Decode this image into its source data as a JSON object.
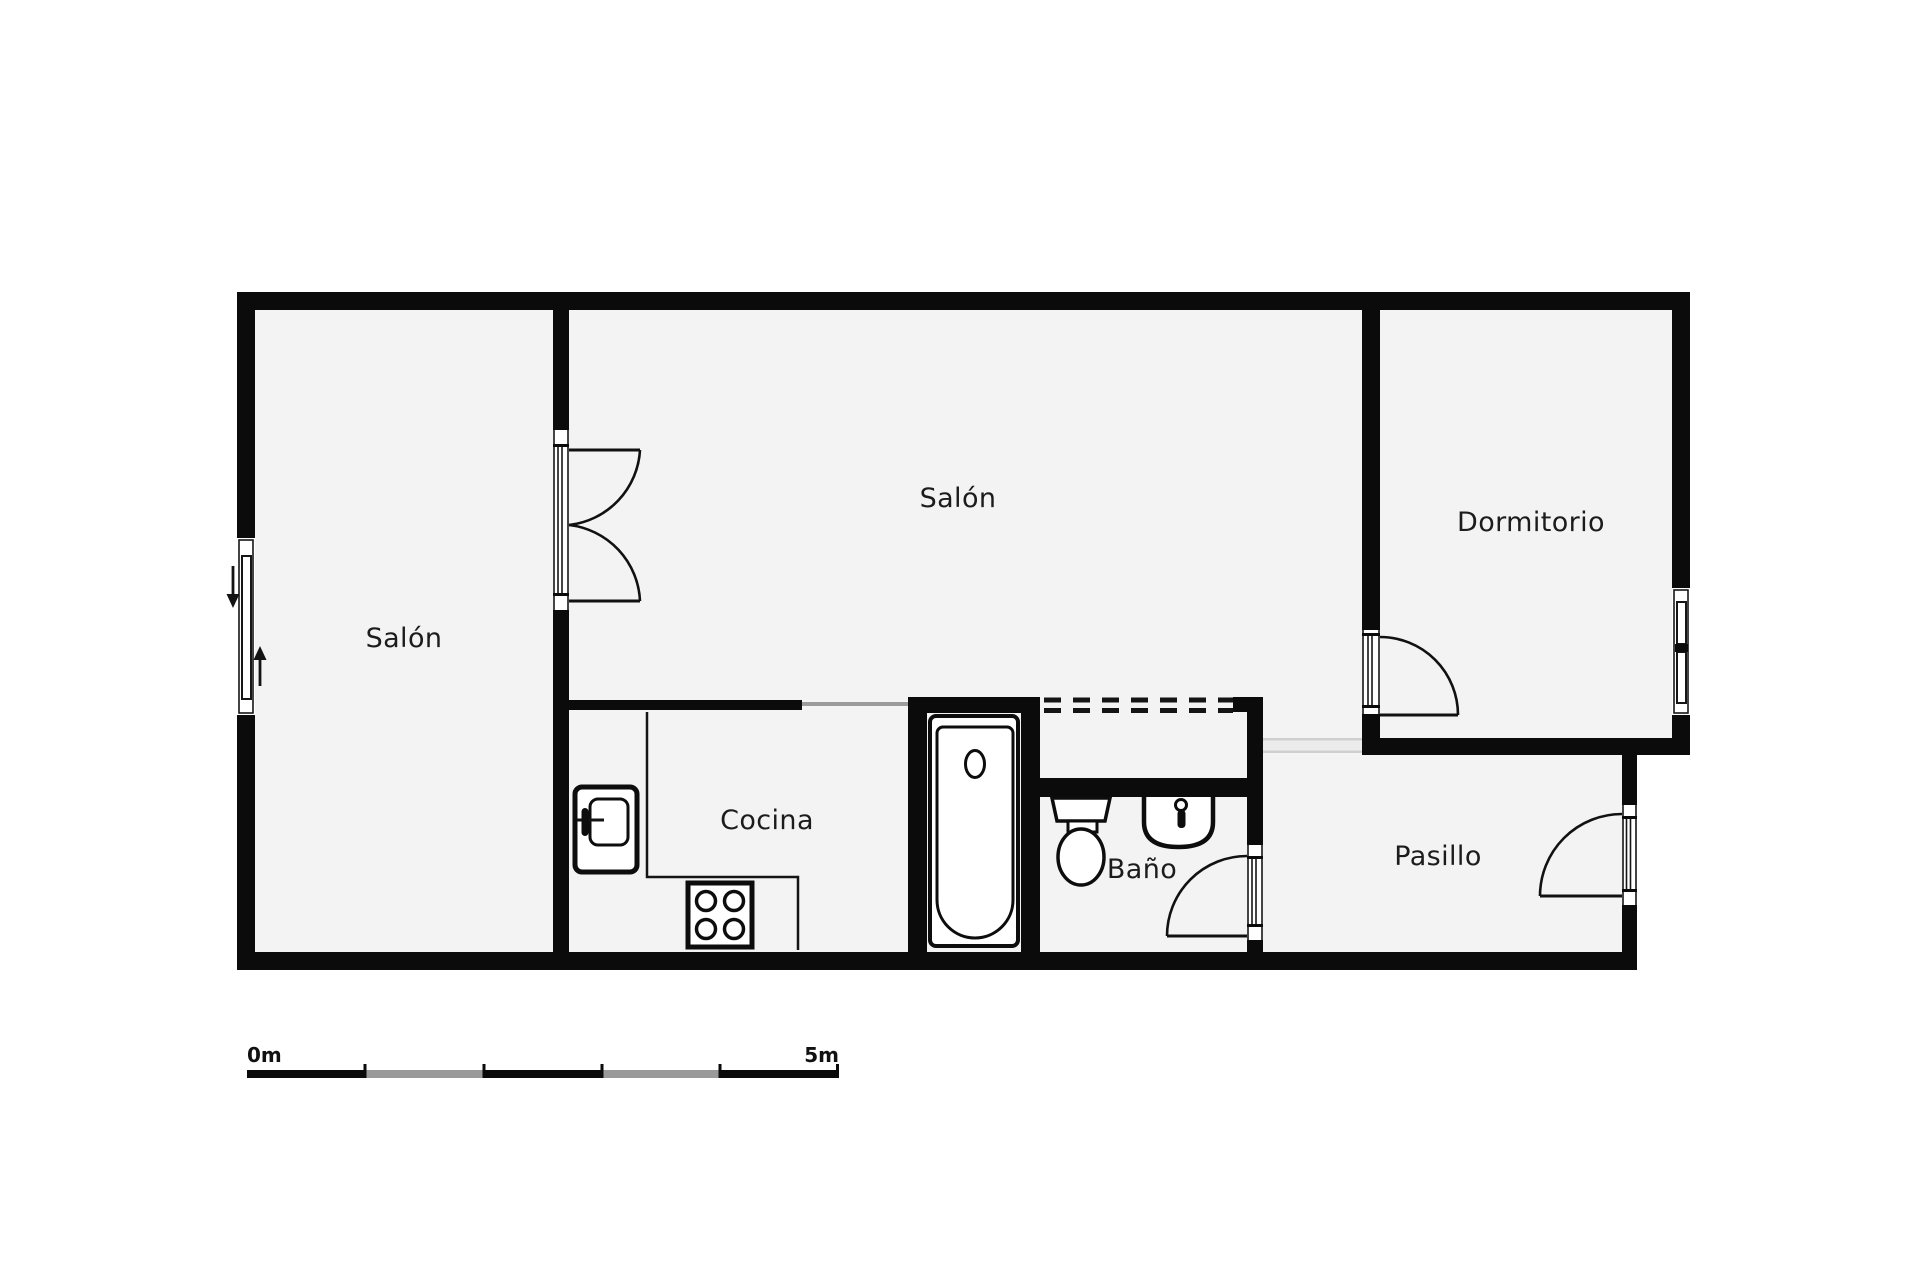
{
  "document": {
    "type": "floor-plan",
    "language": "es"
  },
  "colors": {
    "wall": "#0b0b0b",
    "floor": "#f3f3f4",
    "page": "#ffffff",
    "openline": "#9b9b9b",
    "passage": "#ececec",
    "passageline": "#cfcfcf",
    "ink": "#1c1c1c",
    "scalegray": "#9a9a9a"
  },
  "rooms": [
    {
      "id": "salon-left",
      "label": "Salón"
    },
    {
      "id": "salon-main",
      "label": "Salón"
    },
    {
      "id": "dormitorio",
      "label": "Dormitorio"
    },
    {
      "id": "cocina",
      "label": "Cocina"
    },
    {
      "id": "bano",
      "label": "Baño"
    },
    {
      "id": "pasillo",
      "label": "Pasillo"
    }
  ],
  "fixtures": [
    "bathtub-icon",
    "bathtub-drain-icon",
    "toilet-icon",
    "washbasin-icon",
    "basin-faucet-icon",
    "kitchen-sink-icon",
    "kitchen-faucet-icon",
    "stove-icon",
    "counter-outline",
    "entry-arrow-down-icon",
    "entry-arrow-up-icon"
  ],
  "openings": [
    "entry-window-left",
    "double-door-salon",
    "door-dormitorio",
    "door-bano",
    "door-pasillo",
    "window-dormitorio",
    "open-boundary-cocina",
    "open-passage-pasillo",
    "dashed-open-wall-bano"
  ],
  "scale_bar": {
    "start_label": "0m",
    "end_label": "5m",
    "segments": 5
  }
}
